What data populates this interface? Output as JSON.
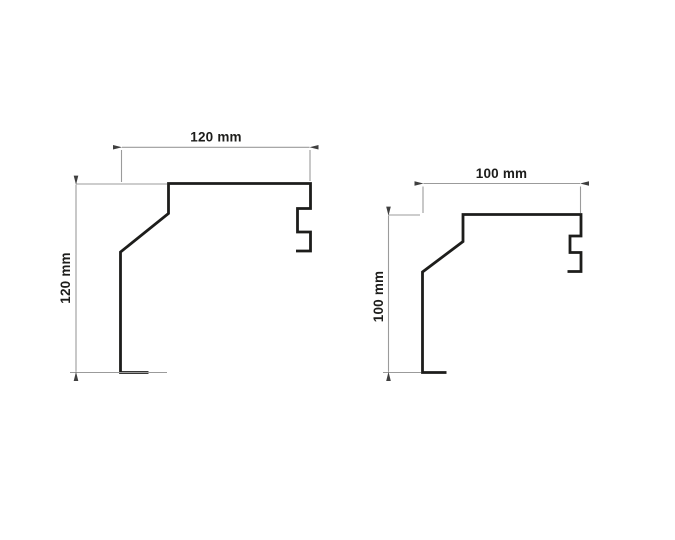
{
  "diagram": {
    "background": "#ffffff",
    "colors": {
      "profile": "#1d1d1b",
      "dimension": "#9b9b9b",
      "arrow": "#3f3f3f",
      "text": "#1d1d1b",
      "background": "#ffffff"
    },
    "profiles": {
      "left": {
        "width_label": "120 mm",
        "height_label": "120 mm"
      },
      "right": {
        "width_label": "100 mm",
        "height_label": "100 mm"
      }
    }
  }
}
